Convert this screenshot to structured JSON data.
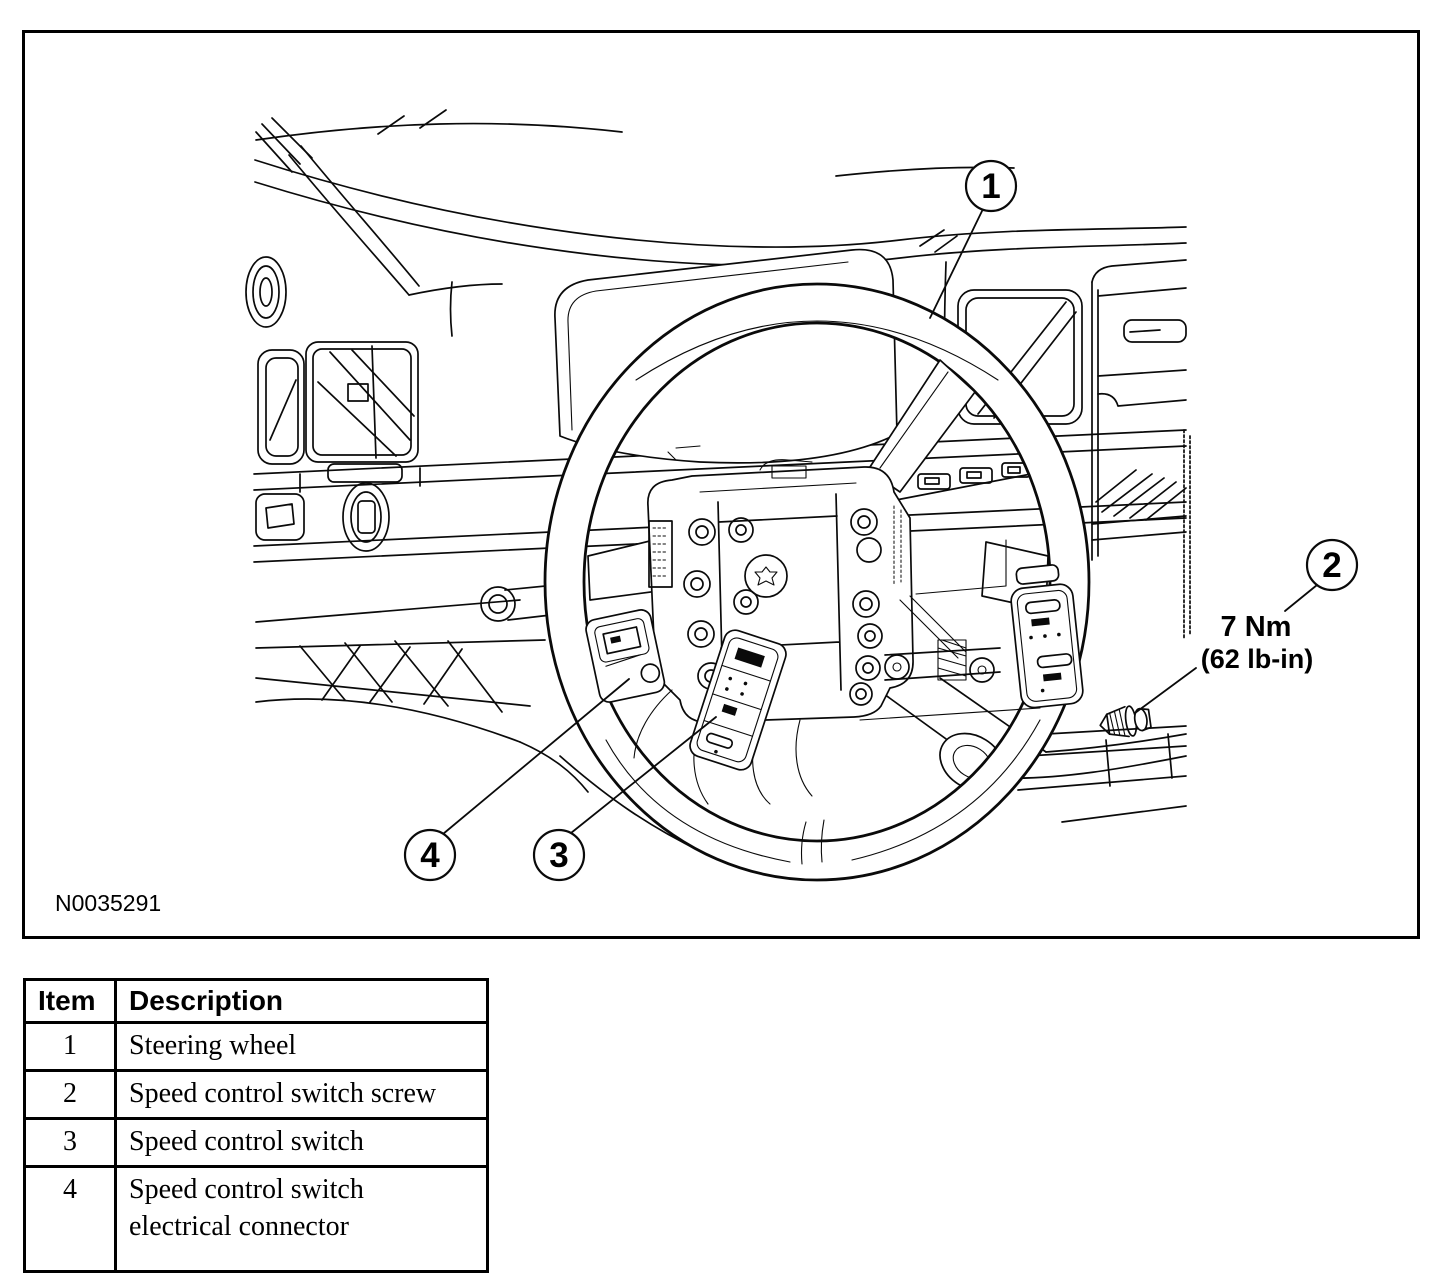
{
  "figure": {
    "id": "N0035291",
    "torque": {
      "metric": "7 Nm",
      "imperial": "(62 lb-in)"
    },
    "callouts": {
      "c1": "1",
      "c2": "2",
      "c3": "3",
      "c4": "4"
    }
  },
  "legend": {
    "headers": {
      "item": "Item",
      "description": "Description"
    },
    "rows": [
      {
        "item": "1",
        "description": "Steering wheel"
      },
      {
        "item": "2",
        "description": "Speed control switch screw"
      },
      {
        "item": "3",
        "description": "Speed control switch"
      },
      {
        "item": "4",
        "description": "Speed control switch\nelectrical connector"
      }
    ]
  },
  "colors": {
    "ink": "#000000",
    "paper": "#ffffff"
  }
}
